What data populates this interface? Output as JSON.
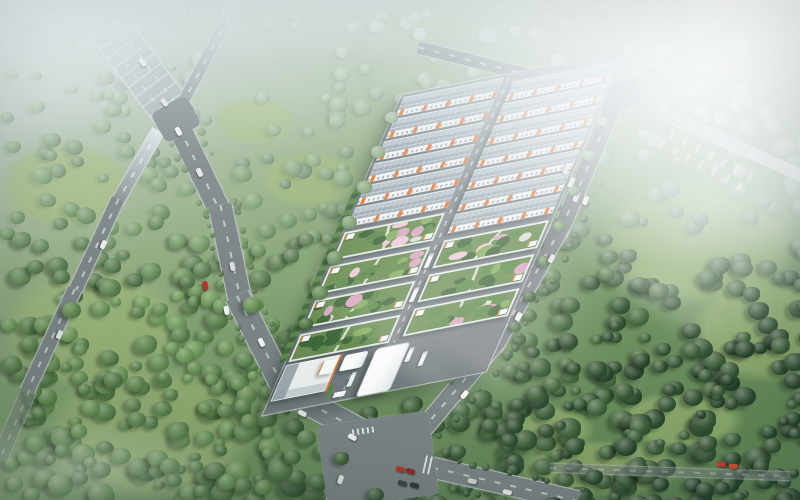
{
  "scene": {
    "type": "aerial-architectural-rendering",
    "subject": "Industrial logistics park with gray gabled warehouses, garden-roof workshop buildings and a gated entrance, set in forested hills",
    "lighting": "hazy morning light, sun rays from upper right",
    "text_content": "none"
  },
  "palette": {
    "road": "#7d8589",
    "campusAsphalt": "#7f888e",
    "roof1": "#b7c1c8",
    "roof2": "#9daab3",
    "ridge": "#8b97a0",
    "skylight": "#c9d3d9",
    "eave": "#76808a",
    "wall": "#f1f4f5",
    "orange": "#e8772e",
    "parapet": "#e9eeee",
    "gardenBase": "#6a8d52",
    "gardenDark": "#41683c",
    "gardenMid": "#5d8a4a",
    "gardenLight": "#84ae60",
    "pink": "#d9a6bf",
    "pinkLight": "#ecc9d6",
    "path": "#d8ded3",
    "canopy": "#f8fbfc",
    "truckWhite": "#f3f6f7",
    "forestLight": "#7fae63",
    "forestDark": "#24402a",
    "forestHaze": "#dde7e9",
    "treeHi": "#eaf2d8",
    "meadow": "#a8c07a"
  },
  "forest": {
    "tree_count": 560,
    "extra_bottom_right": 150,
    "extra_bottom_left": 90,
    "meadows": [
      [
        95,
        330,
        130,
        85
      ],
      [
        150,
        432,
        150,
        95
      ],
      [
        65,
        185,
        95,
        60
      ],
      [
        700,
        240,
        140,
        95
      ],
      [
        765,
        330,
        105,
        75
      ],
      [
        688,
        62,
        85,
        50
      ],
      [
        600,
        468,
        120,
        40
      ],
      [
        310,
        180,
        70,
        40
      ],
      [
        255,
        120,
        60,
        35
      ],
      [
        430,
        20,
        80,
        30
      ],
      [
        545,
        430,
        70,
        35
      ],
      [
        680,
        420,
        90,
        40
      ]
    ],
    "overhang_trees": [
      [
        385,
        112,
        13
      ],
      [
        371,
        146,
        14
      ],
      [
        357,
        181,
        15
      ],
      [
        342,
        216,
        15
      ],
      [
        327,
        251,
        16
      ],
      [
        312,
        286,
        16
      ],
      [
        299,
        318,
        14
      ],
      [
        597,
        117,
        11
      ],
      [
        583,
        151,
        12
      ],
      [
        568,
        186,
        12
      ],
      [
        553,
        221,
        13
      ],
      [
        538,
        256,
        13
      ],
      [
        523,
        291,
        13
      ],
      [
        509,
        322,
        12
      ],
      [
        150,
        178,
        17
      ],
      [
        243,
        297,
        19
      ],
      [
        236,
        352,
        18
      ],
      [
        297,
        430,
        19
      ],
      [
        334,
        452,
        15
      ],
      [
        637,
        149,
        15
      ],
      [
        601,
        250,
        17
      ],
      [
        559,
        333,
        19
      ],
      [
        506,
        419,
        17
      ],
      [
        616,
        438,
        21
      ],
      [
        367,
        488,
        17
      ],
      [
        543,
        497,
        19
      ],
      [
        658,
        102,
        13
      ],
      [
        692,
        212,
        17
      ],
      [
        748,
        302,
        21
      ],
      [
        118,
        132,
        13
      ],
      [
        62,
        302,
        19
      ],
      [
        168,
        422,
        21
      ],
      [
        92,
        462,
        19
      ],
      [
        28,
        260,
        16
      ],
      [
        205,
        462,
        20
      ],
      [
        255,
        480,
        18
      ],
      [
        450,
        445,
        16
      ],
      [
        585,
        470,
        18
      ]
    ]
  },
  "roads": {
    "segments": [
      {
        "id": "highway-northwest",
        "mx": 122,
        "my": 45,
        "len": 190,
        "w": 42,
        "rot": -37,
        "cls": "wide hazy"
      },
      {
        "id": "road-north",
        "mx": 212,
        "my": 46,
        "len": 165,
        "w": 13,
        "rot": 28,
        "cls": "hazy"
      },
      {
        "id": "perimeter-1",
        "mx": 197,
        "my": 164,
        "len": 116,
        "w": 24,
        "rot": -26,
        "cls": "trees"
      },
      {
        "id": "perimeter-2",
        "mx": 230,
        "my": 255,
        "len": 102,
        "w": 25,
        "rot": -12,
        "cls": "trees"
      },
      {
        "id": "perimeter-3",
        "mx": 262,
        "my": 345,
        "len": 110,
        "w": 26,
        "rot": -27,
        "cls": "trees"
      },
      {
        "id": "perimeter-4",
        "mx": 342,
        "my": 421,
        "len": 142,
        "w": 26,
        "rot": -62,
        "cls": "trees"
      },
      {
        "id": "east-road-1",
        "mx": 589,
        "my": 163,
        "len": 155,
        "w": 18,
        "rot": 23,
        "cls": "trees"
      },
      {
        "id": "east-road-2",
        "mx": 527,
        "my": 287,
        "len": 140,
        "w": 19,
        "rot": 29,
        "cls": "trees"
      },
      {
        "id": "east-road-3",
        "mx": 450,
        "my": 397,
        "len": 146,
        "w": 20,
        "rot": 40,
        "cls": "trees"
      },
      {
        "id": "campus-north-road",
        "mx": 521,
        "my": 73,
        "len": 212,
        "w": 14,
        "rot": -76,
        "cls": ""
      },
      {
        "id": "road-northeast",
        "mx": 640,
        "my": 42,
        "len": 125,
        "w": 11,
        "rot": 25,
        "cls": "hazy"
      },
      {
        "id": "road-east-fading",
        "mx": 714,
        "my": 136,
        "len": 215,
        "w": 12,
        "rot": -66,
        "cls": "fade"
      },
      {
        "id": "exit-south",
        "mx": 342,
        "my": 477,
        "len": 66,
        "w": 17,
        "rot": 19,
        "cls": ""
      },
      {
        "id": "exit-southeast",
        "mx": 497,
        "my": 482,
        "len": 165,
        "w": 22,
        "rot": -77,
        "cls": "trees"
      },
      {
        "id": "road-south-faint",
        "mx": 670,
        "my": 472,
        "len": 240,
        "w": 10,
        "rot": -88,
        "cls": "faint"
      },
      {
        "id": "west-road-1",
        "mx": 138,
        "my": 166,
        "len": 82,
        "w": 14,
        "rot": 30,
        "cls": "hazy"
      },
      {
        "id": "west-road-2",
        "mx": 96,
        "my": 245,
        "len": 102,
        "w": 15,
        "rot": 25,
        "cls": ""
      },
      {
        "id": "west-road-3",
        "mx": 51,
        "my": 340,
        "len": 112,
        "w": 16,
        "rot": 25,
        "cls": ""
      },
      {
        "id": "west-road-4",
        "mx": 14,
        "my": 424,
        "len": 74,
        "w": 17,
        "rot": 23,
        "cls": "faint"
      }
    ],
    "junctions": [
      [
        156,
        102,
        40,
        34,
        -30
      ],
      [
        322,
        418,
        112,
        84,
        -8
      ],
      [
        596,
        82,
        44,
        28,
        -18
      ]
    ],
    "crosswalks": [
      [
        352,
        428,
        22,
        6,
        -8
      ],
      [
        424,
        456,
        8,
        18,
        13
      ]
    ]
  },
  "vehicles": {
    "cars": [
      [
        176,
        127,
        -28,
        "#f2f3f3"
      ],
      [
        197,
        168,
        -26,
        "#e6e8e8"
      ],
      [
        203,
        281,
        -12,
        "#b8352a"
      ],
      [
        224,
        306,
        -12,
        "#f4f5f5"
      ],
      [
        230,
        262,
        -12,
        "#dadcdc"
      ],
      [
        259,
        338,
        -27,
        "#f6f7f7"
      ],
      [
        300,
        409,
        -62,
        "#e2e4e4"
      ],
      [
        350,
        433,
        -62,
        "#f7f7f7"
      ],
      [
        398,
        465,
        -75,
        "#b8352a"
      ],
      [
        408,
        467,
        -75,
        "#97271e"
      ],
      [
        400,
        479,
        -75,
        "#3a4248"
      ],
      [
        412,
        481,
        -75,
        "#2e363c"
      ],
      [
        719,
        460,
        -88,
        "#c13a2e"
      ],
      [
        731,
        462,
        -88,
        "#cc4a32"
      ],
      [
        583,
        196,
        23,
        "#eef0f0"
      ],
      [
        549,
        254,
        29,
        "#e0e3e3"
      ],
      [
        516,
        312,
        29,
        "#f2f4f4"
      ],
      [
        462,
        390,
        40,
        "#fbfbfb"
      ],
      [
        338,
        475,
        19,
        "#e9eaea"
      ],
      [
        470,
        477,
        -77,
        "#d8dada"
      ],
      [
        505,
        488,
        -77,
        "#f1f2f2"
      ],
      [
        140,
        58,
        -37,
        "#ebecec"
      ],
      [
        162,
        98,
        -37,
        "#e2e3e3"
      ],
      [
        101,
        240,
        25,
        "#edeeee"
      ],
      [
        57,
        330,
        25,
        "#e6e7e7"
      ]
    ],
    "parked_trailers": [
      [
        660,
        139
      ],
      [
        673,
        146
      ],
      [
        686,
        153
      ],
      [
        699,
        160
      ],
      [
        712,
        167
      ],
      [
        725,
        174
      ],
      [
        738,
        181
      ],
      [
        670,
        130
      ],
      [
        683,
        137
      ],
      [
        696,
        144
      ],
      [
        709,
        151
      ],
      [
        722,
        158
      ],
      [
        735,
        165
      ],
      [
        748,
        172
      ]
    ],
    "edge_trucks": [
      [
        564,
        163
      ],
      [
        569,
        177
      ],
      [
        574,
        191
      ]
    ],
    "campus_trucks": [
      [
        109,
        195
      ],
      [
        109,
        232
      ],
      [
        80,
        318
      ],
      [
        133,
        302
      ],
      [
        150,
        310
      ]
    ]
  },
  "campus": {
    "columns": [
      {
        "x": 3,
        "w": 103,
        "grayStart": 3,
        "grayRows": 6,
        "greenStart": 150,
        "greenRows": 4
      },
      {
        "x": 119,
        "w": 108,
        "grayStart": 10,
        "grayRows": 7,
        "greenStart": 183,
        "greenRows": 3
      }
    ],
    "gray_pitch": 24,
    "gray_height": 21,
    "green_pitch": 37,
    "green_height": 30,
    "garden_blobs_per_building": 14
  }
}
